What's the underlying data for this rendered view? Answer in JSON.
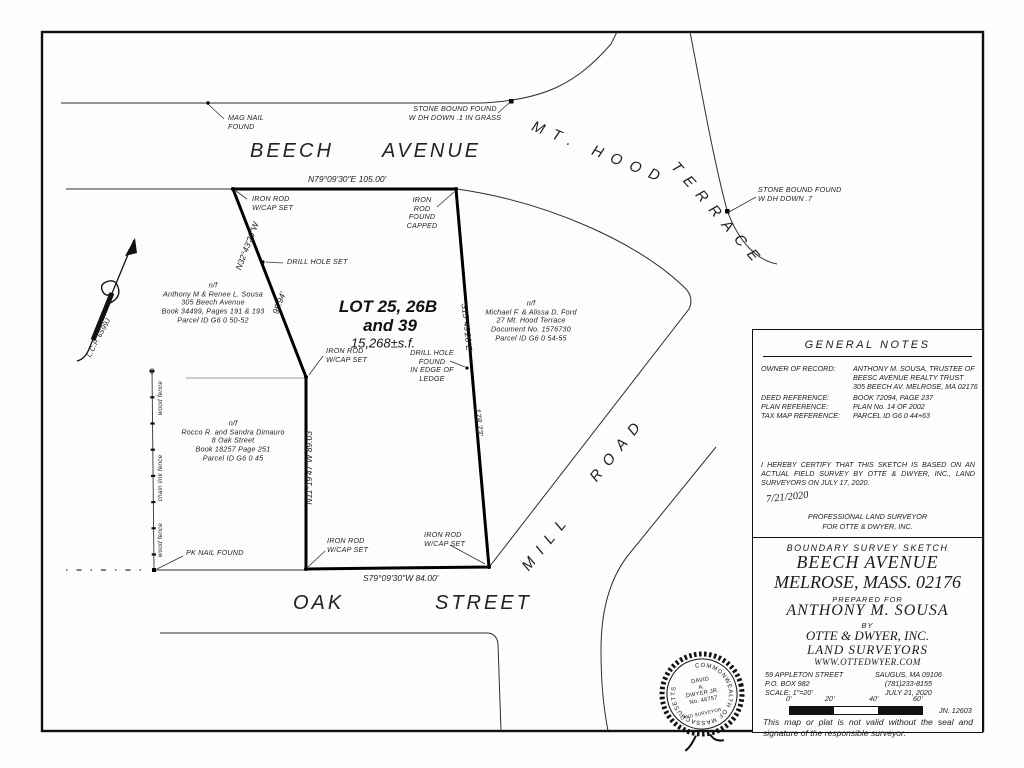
{
  "streets": {
    "beech": "BEECH",
    "avenue": "AVENUE",
    "mt_hood": "MT. HOOD",
    "terrace": "TERRACE",
    "mill": "MILL",
    "road": "ROAD",
    "oak": "OAK",
    "street": "STREET"
  },
  "lot": {
    "name_line1": "LOT 25, 26B",
    "name_line2": "and 39",
    "area": "15,268±s.f."
  },
  "bearings": {
    "beech_line": "N79°09'30\"E   105.00'",
    "oak_line": "S79°09'30\"W   84.00'",
    "west_line": "N11°19'47\"W  89.03'",
    "northwest_bearing": "N32°43'29\"W",
    "northwest_distance": "95.94'",
    "east_bearing": "S15°49'20\"E",
    "east_distance": "178.73'"
  },
  "monuments": {
    "mag_nail": "MAG NAIL\nFOUND",
    "stone_bound_grass": "STONE BOUND FOUND\nW DH DOWN .1 IN GRASS",
    "stone_bound_7": "STONE BOUND FOUND\nW DH DOWN .7",
    "iron_rod_cap_set": "IRON ROD\nW/CAP SET",
    "iron_rod_found": "IRON ROD\nFOUND\nCAPPED",
    "drill_hole_set": "DRILL HOLE SET",
    "drill_hole_found": "DRILL HOLE FOUND\nIN EDGE OF LEDGE",
    "pk_nail": "PK NAIL FOUND"
  },
  "abutters": {
    "sousa": "n/f\nAnthony M & Renee L. Sousa\n305 Beech Avenue\nBook 34499, Pages 191 & 193\nParcel ID G6 0 50-52",
    "ford": "n/f\nMichael F. & Alissa D. Ford\n27 Mt. Hood Terrace\nDocument No. 1576730\nParcel ID G6 0 54-55",
    "dimauro": "n/f\nRocco R. and Sandra Dimauro\n8 Oak Street\nBook 18257 Page 251\nParcel ID G6 0 45"
  },
  "annotations": {
    "lcp": "L.C.P. 6599J",
    "fence_wood_upper": "wood fence",
    "fence_chain": "chain link fence",
    "fence_wood_lower": "wood fence"
  },
  "general_notes": {
    "title": "GENERAL NOTES",
    "owner_label": "OWNER OF RECORD:",
    "owner_value": "ANTHONY M. SOUSA, TRUSTEE OF\nBEESC AVENUE REALTY TRUST\n305 BEECH AV. MELROSE, MA 02176",
    "deed_label": "DEED REFERENCE:",
    "deed_value": "BOOK 72094,  PAGE 237",
    "plan_label": "PLAN REFERENCE:",
    "plan_value": "PLAN No. 14 OF 2002",
    "tax_label": "TAX MAP REFERENCE:",
    "tax_value": "PARCEL ID G6 0 44+63"
  },
  "certification": {
    "statement": "I HEREBY CERTIFY THAT THIS SKETCH IS BASED ON AN ACTUAL FIELD SURVEY BY OTTE & DWYER, INC., LAND SURVEYORS ON JULY 17, 2020.",
    "date": "7/21/2020",
    "role_line1": "PROFESSIONAL LAND SURVEYOR",
    "role_line2": "FOR OTTE & DWYER, INC."
  },
  "title_block": {
    "kind": "BOUNDARY SURVEY SKETCH",
    "street": "BEECH AVENUE",
    "city": "MELROSE, MASS. 02176",
    "prepared_for": "PREPARED FOR",
    "client": "ANTHONY M. SOUSA",
    "by": "BY",
    "firm": "OTTE & DWYER, INC.",
    "firm2": "LAND SURVEYORS",
    "website": "WWW.OTTEDWYER.COM",
    "address_left": "59 APPLETON STREET\nP.O. BOX 982\nSCALE: 1\"=20'",
    "address_right": "SAUGUS, MA 09106\n(781)233-8155\nJULY 21, 2020",
    "scale_ticks": [
      "0'",
      "20'",
      "40'",
      "60'"
    ],
    "job_number": "JN. 12603",
    "disclaimer": "This map or plat is not valid without the seal and signature of the responsible surveyor."
  },
  "seal": {
    "ring": "COMMONWEALTH OF MASSACHUSETTS",
    "name": "DAVID\nA.\nDWYER JR.\nNo. 46757",
    "title": "LAND SURVEYOR"
  }
}
